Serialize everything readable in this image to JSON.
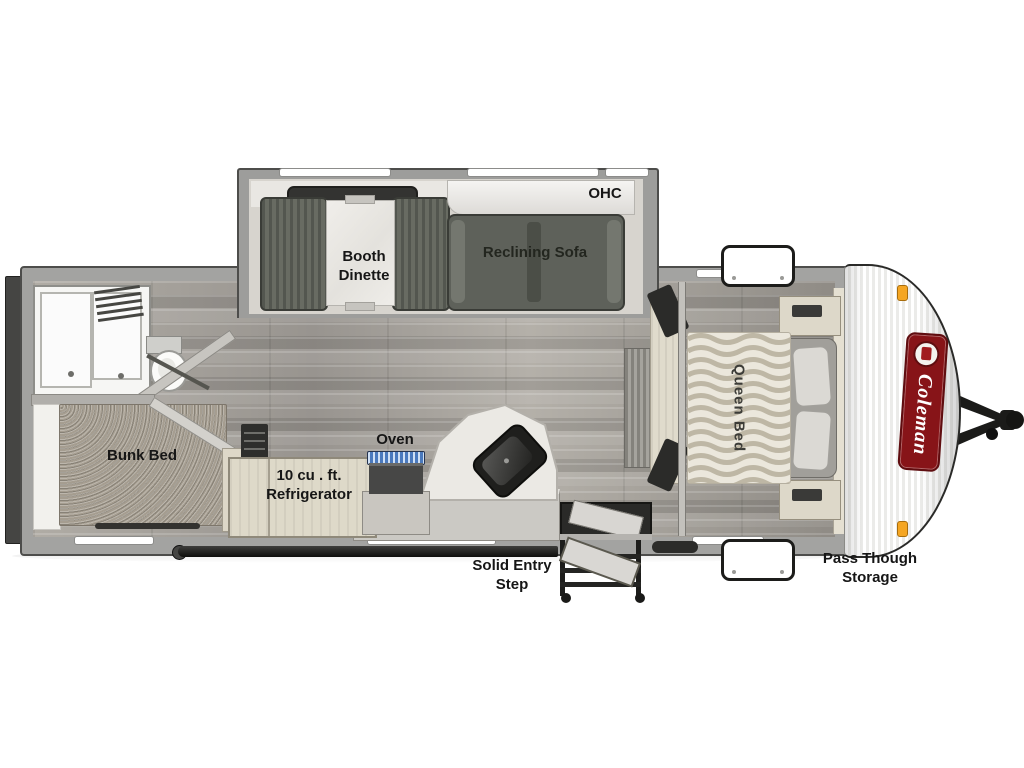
{
  "document": {
    "type": "travel trailer floor plan",
    "brand": "Coleman"
  },
  "labels": {
    "ohc": "OHC",
    "booth_dinette_line1": "Booth",
    "booth_dinette_line2": "Dinette",
    "reclining_sofa": "Reclining Sofa",
    "bunk_bed": "Bunk Bed",
    "oven": "Oven",
    "refrigerator_line1": "10 cu . ft.",
    "refrigerator_line2": "Refrigerator",
    "queen_bed": "Queen Bed",
    "solid_entry_line1": "Solid Entry",
    "solid_entry_line2": "Step",
    "pass_through_line1": "Pass Though",
    "pass_through_line2": "Storage",
    "brand": "Coleman"
  },
  "colors": {
    "brand_red": "#871418",
    "marker_amber": "#f5a623",
    "label_text": "#161616"
  }
}
